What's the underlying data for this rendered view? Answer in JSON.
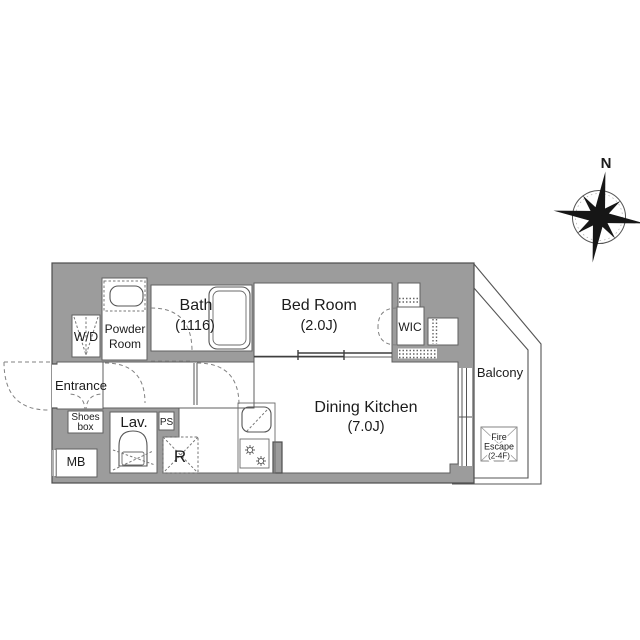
{
  "compass": {
    "north": "N"
  },
  "rooms": {
    "bath": {
      "name": "Bath",
      "size": "(1116)"
    },
    "bedroom": {
      "name": "Bed Room",
      "size": "(2.0J)"
    },
    "dining_kitchen": {
      "name": "Dining Kitchen",
      "size": "(7.0J)"
    },
    "wic": {
      "name": "WIC"
    },
    "washer_dryer": {
      "name": "W/D"
    },
    "powder_room": {
      "line1": "Powder",
      "line2": "Room"
    },
    "entrance": {
      "name": "Entrance"
    },
    "shoes_box": {
      "line1": "Shoes",
      "line2": "box"
    },
    "lavatory": {
      "name": "Lav."
    },
    "pipe_space": {
      "name": "PS"
    },
    "refrigerator_space": {
      "name": "R"
    },
    "meter_box": {
      "name": "MB"
    },
    "balcony": {
      "name": "Balcony"
    },
    "fire_escape": {
      "line1": "Fire",
      "line2": "Escape",
      "line3": "(2-4F)"
    }
  },
  "colors": {
    "wall": "#9c9c9c",
    "wall_edge": "#4d4d4d",
    "fixture_line": "#555555",
    "door_dash": "#808080",
    "text": "#1c1c1c",
    "background": "#ffffff"
  }
}
